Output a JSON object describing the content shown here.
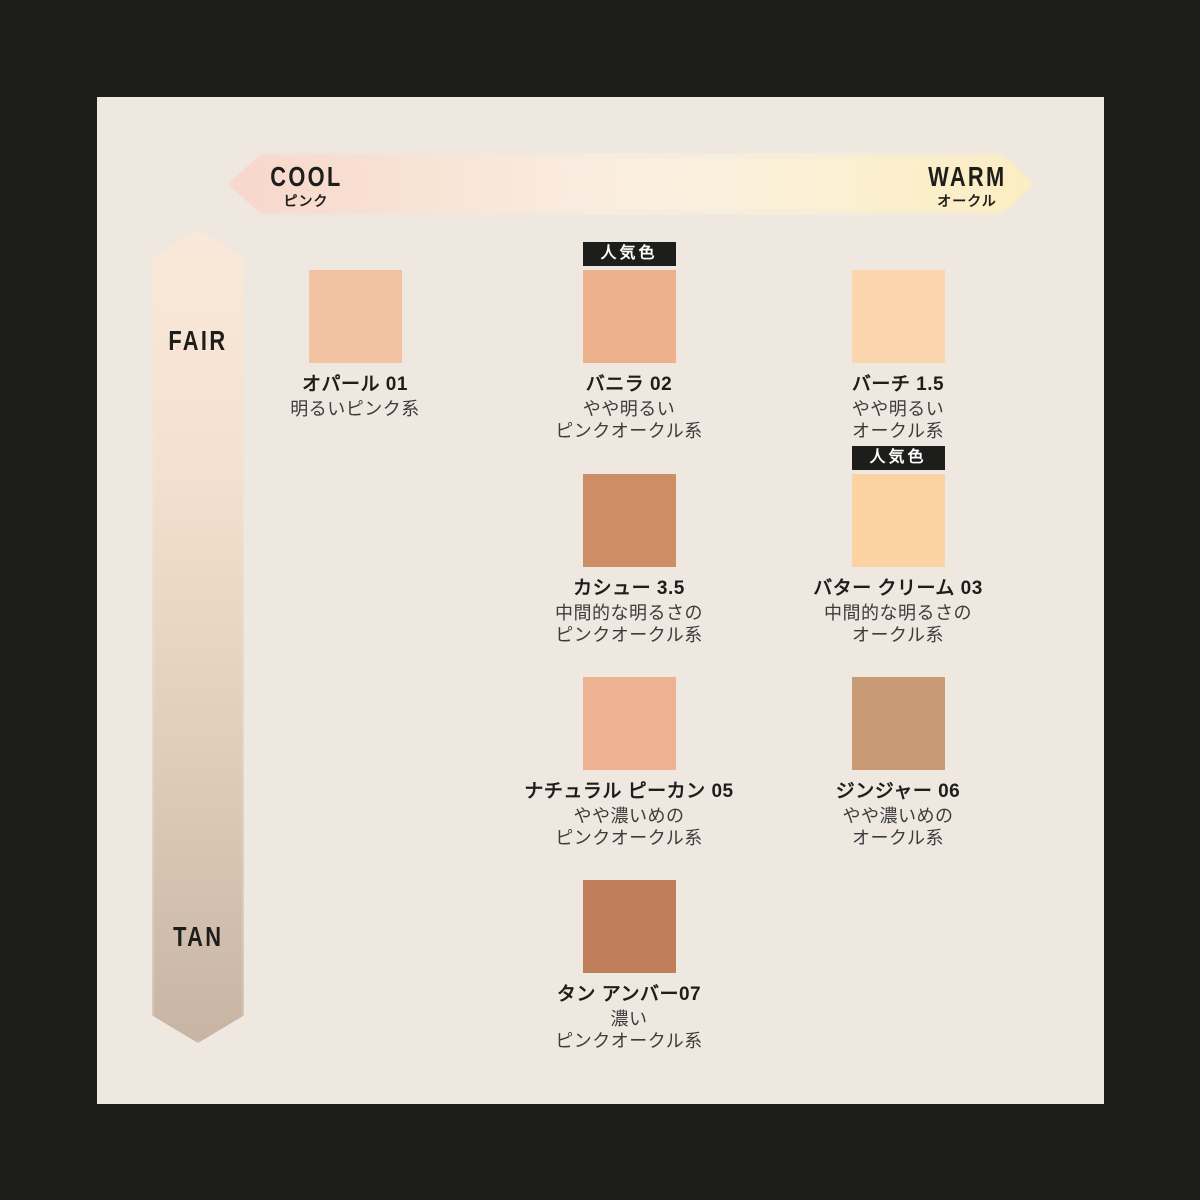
{
  "frame_color": "#1D1D1B",
  "panel_color": "#EEE8E1",
  "horizontal_axis": {
    "left_label": "COOL",
    "left_sublabel": "ピンク",
    "right_label": "WARM",
    "right_sublabel": "オークル",
    "gradient": [
      "#F8D6CB 0%",
      "#F8E2D3 22%",
      "#FAEDE0 45%",
      "#FAF0DC 62%",
      "#FBEFCB 85%",
      "#FBEDC2 100%"
    ]
  },
  "vertical_axis": {
    "top_label": "FAIR",
    "bottom_label": "TAN",
    "gradient": [
      "#FAE9DA 0%",
      "#F4E0CE 30%",
      "#DFCCB9 65%",
      "#C7B4A3 100%"
    ]
  },
  "badge_label": "人気色",
  "shades": [
    {
      "name": "オパール 01",
      "desc": [
        "明るいピンク系"
      ],
      "color": "#F2C3A3",
      "popular": false
    },
    {
      "name": "バニラ 02",
      "desc": [
        "やや明るい",
        "ピンクオークル系"
      ],
      "color": "#EDB18D",
      "popular": true
    },
    {
      "name": "バーチ 1.5",
      "desc": [
        "やや明るい",
        "オークル系"
      ],
      "color": "#FBD5AE",
      "popular": false
    },
    {
      "name": "カシュー 3.5",
      "desc": [
        "中間的な明るさの",
        "ピンクオークル系"
      ],
      "color": "#CE8E65",
      "popular": false
    },
    {
      "name": "バター クリーム 03",
      "desc": [
        "中間的な明るさの",
        "オークル系"
      ],
      "color": "#FBD2A2",
      "popular": true
    },
    {
      "name": "ナチュラル ピーカン 05",
      "desc": [
        "やや濃いめの",
        "ピンクオークル系"
      ],
      "color": "#ECB292",
      "popular": false
    },
    {
      "name": "ジンジャー 06",
      "desc": [
        "やや濃いめの",
        "オークル系"
      ],
      "color": "#C89A76",
      "popular": false
    },
    {
      "name": "タン アンバー07",
      "desc": [
        "濃い",
        "ピンクオークル系"
      ],
      "color": "#C07E5A",
      "popular": false
    }
  ]
}
